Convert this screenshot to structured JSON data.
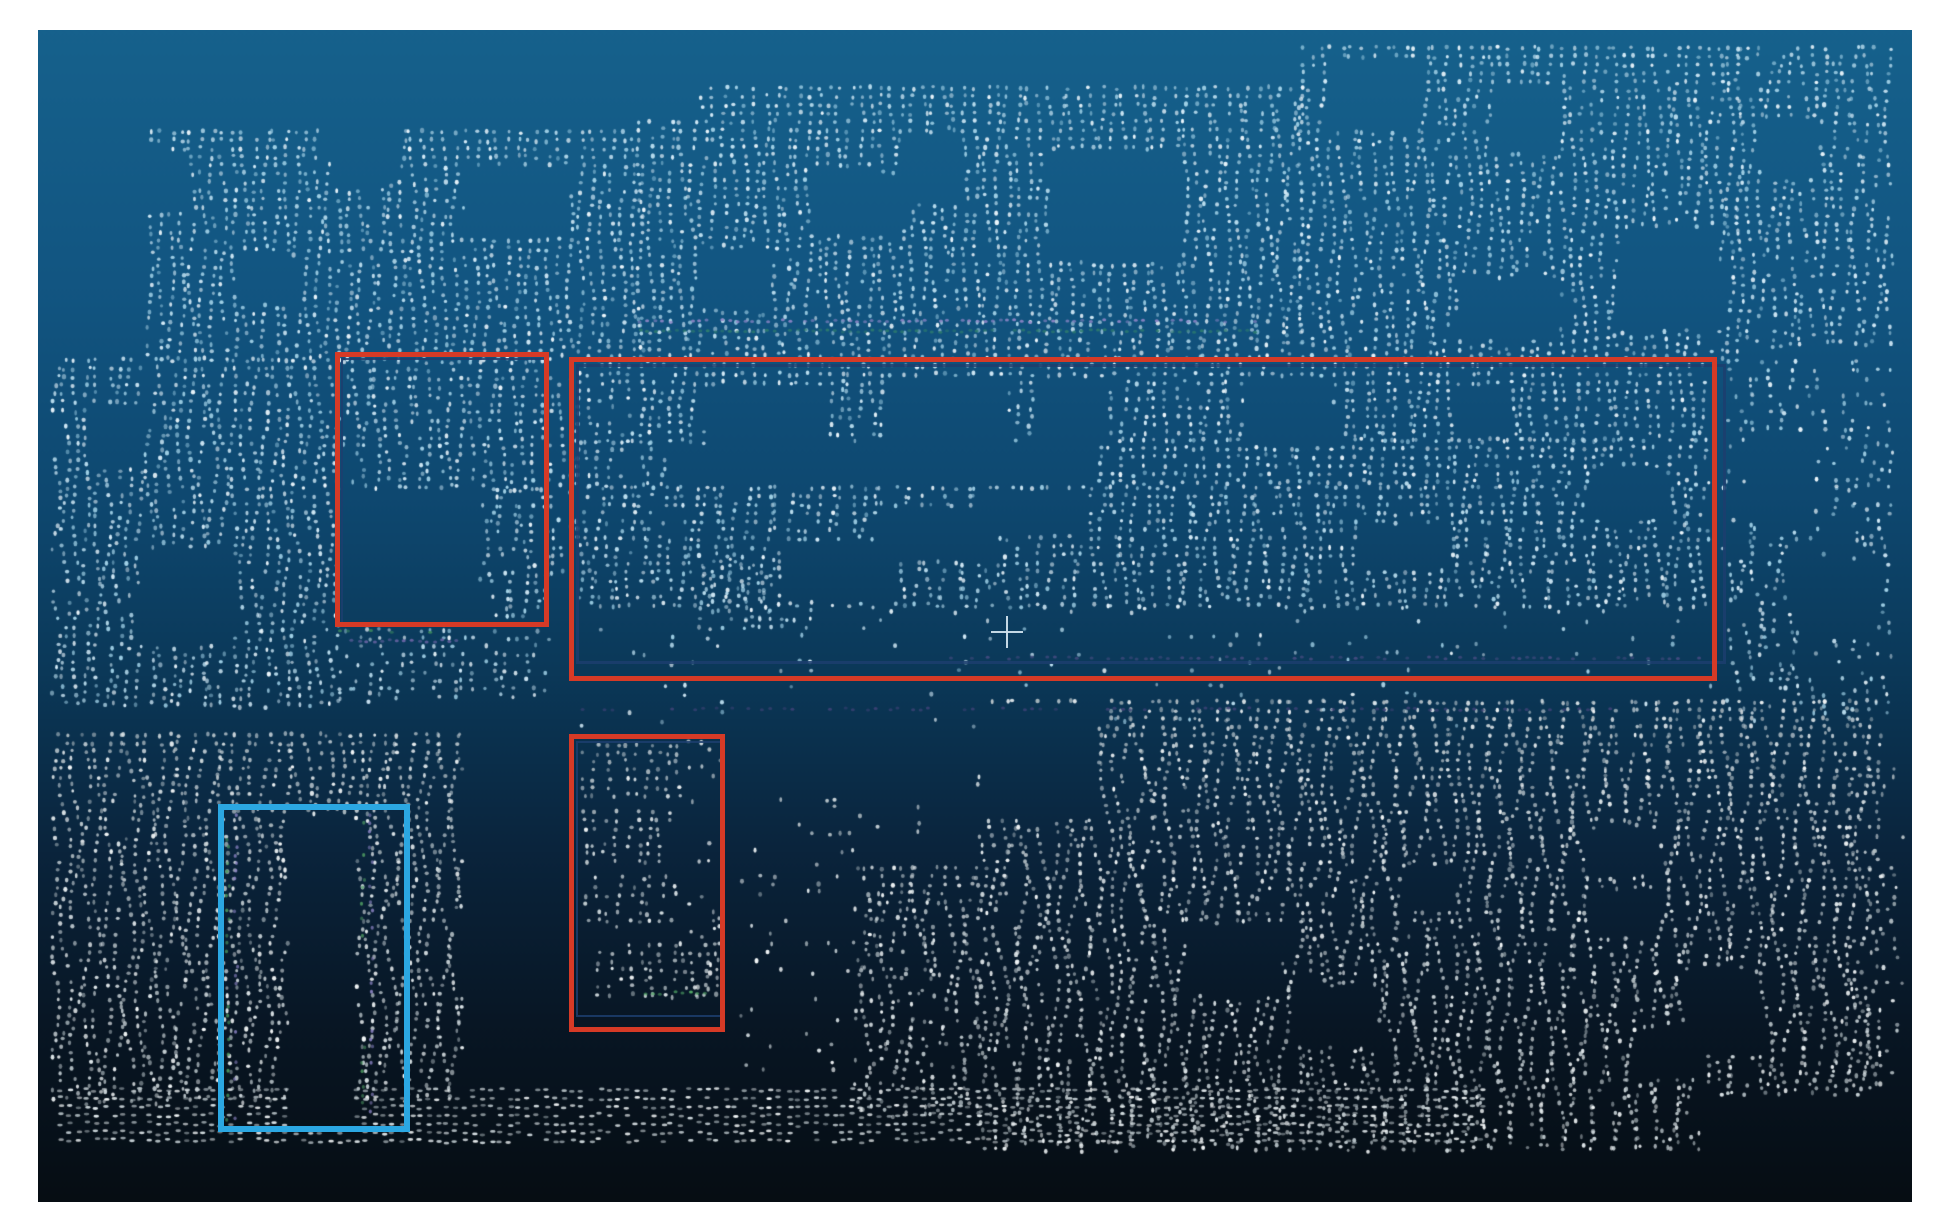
{
  "window": {
    "frame_color": "#ffffff",
    "viewport": {
      "x": 38,
      "y": 30,
      "w": 1874,
      "h": 1172
    },
    "background_gradient": [
      [
        0.0,
        "#16618c"
      ],
      [
        0.22,
        "#125581"
      ],
      [
        0.4,
        "#0e4870"
      ],
      [
        0.55,
        "#0b3858"
      ],
      [
        0.7,
        "#0a243c"
      ],
      [
        0.85,
        "#081624"
      ],
      [
        1.0,
        "#060d13"
      ]
    ]
  },
  "annotations": {
    "red_color": "#d63a26",
    "cyan_color": "#2ba7e2",
    "ghost_color": "#1c3e6e",
    "boxes": [
      {
        "id": "red-annotation-box-1",
        "color": "#d63a26",
        "x": 335,
        "y": 352,
        "w": 214,
        "h": 275,
        "stroke": 5
      },
      {
        "id": "red-annotation-box-2",
        "color": "#d63a26",
        "x": 569,
        "y": 357,
        "w": 1148,
        "h": 324,
        "stroke": 5
      },
      {
        "id": "red-annotation-box-3",
        "color": "#d63a26",
        "x": 569,
        "y": 734,
        "w": 156,
        "h": 298,
        "stroke": 5
      },
      {
        "id": "cyan-annotation-box-1",
        "color": "#2ba7e2",
        "x": 218,
        "y": 804,
        "w": 192,
        "h": 328,
        "stroke": 6
      }
    ],
    "ghost_boxes": [
      {
        "x": 576,
        "y": 364,
        "w": 1150,
        "h": 300,
        "stroke": 3
      },
      {
        "x": 341,
        "y": 358,
        "w": 207,
        "h": 266,
        "stroke": 2
      },
      {
        "x": 576,
        "y": 741,
        "w": 146,
        "h": 276,
        "stroke": 2
      }
    ],
    "crosshair": {
      "x": 1007,
      "y": 632,
      "arm": 16,
      "thickness": 2.5,
      "color": "#cfe0ec"
    }
  },
  "pointcloud": {
    "seed": 20240601,
    "grid": {
      "dx": 10.5,
      "dy": 8.4,
      "dot_w": 3.4,
      "dot_h": 4.2
    },
    "palette_blue": [
      "#eaf5fb",
      "#d2eaf7",
      "#b9ddee",
      "#a0d0e6"
    ],
    "palette_gray": [
      "#f1f5f6",
      "#dfe7ea",
      "#cad4d8",
      "#b6c1c6"
    ],
    "regions": [
      {
        "x": 150,
        "y": 132,
        "w": 490,
        "h": 228,
        "d": 0.92,
        "tint": "blue",
        "wave": 3.0
      },
      {
        "x": 640,
        "y": 88,
        "w": 660,
        "h": 272,
        "d": 0.9,
        "tint": "blue",
        "wave": 3.0
      },
      {
        "x": 1300,
        "y": 48,
        "w": 440,
        "h": 312,
        "d": 0.86,
        "tint": "blue",
        "wave": 3.5
      },
      {
        "x": 1740,
        "y": 48,
        "w": 150,
        "h": 300,
        "d": 0.78,
        "tint": "blue",
        "wave": 4.0
      },
      {
        "x": 55,
        "y": 360,
        "w": 282,
        "h": 348,
        "d": 0.9,
        "tint": "blue",
        "wave": 4.0
      },
      {
        "x": 337,
        "y": 630,
        "w": 210,
        "h": 72,
        "d": 0.55,
        "tint": "blue",
        "wave": 3.0
      },
      {
        "x": 345,
        "y": 362,
        "w": 196,
        "h": 128,
        "d": 0.85,
        "tint": "blue",
        "wave": 3.0
      },
      {
        "x": 482,
        "y": 490,
        "w": 66,
        "h": 132,
        "d": 0.7,
        "tint": "blue",
        "wave": 4.0
      },
      {
        "x": 551,
        "y": 378,
        "w": 18,
        "h": 195,
        "d": 0.6,
        "tint": "blue",
        "wave": 2.0
      },
      {
        "x": 578,
        "y": 366,
        "w": 1128,
        "h": 76,
        "d": 0.88,
        "tint": "blue",
        "wave": 3.0
      },
      {
        "x": 578,
        "y": 442,
        "w": 84,
        "h": 46,
        "d": 0.8,
        "tint": "blue",
        "wave": 3.0
      },
      {
        "x": 1100,
        "y": 440,
        "w": 606,
        "h": 48,
        "d": 0.85,
        "tint": "blue",
        "wave": 3.0
      },
      {
        "x": 578,
        "y": 488,
        "w": 1128,
        "h": 122,
        "d": 0.85,
        "tint": "blue",
        "wave": 4.0
      },
      {
        "x": 700,
        "y": 560,
        "w": 115,
        "h": 72,
        "d": 0.7,
        "tint": "blue",
        "wave": 4.0
      },
      {
        "x": 590,
        "y": 612,
        "w": 1110,
        "h": 60,
        "d": 0.1,
        "tint": "blue",
        "wave": 3.0
      },
      {
        "x": 1725,
        "y": 362,
        "w": 165,
        "h": 358,
        "d": 0.5,
        "tint": "blue",
        "wave": 5.0
      },
      {
        "x": 578,
        "y": 686,
        "w": 1130,
        "h": 42,
        "d": 0.07,
        "tint": "blue",
        "wave": 3.0
      },
      {
        "x": 55,
        "y": 735,
        "w": 405,
        "h": 368,
        "d": 0.92,
        "tint": "gray",
        "wave": 5.0
      },
      {
        "x": 585,
        "y": 745,
        "w": 95,
        "h": 55,
        "d": 0.8,
        "tint": "gray",
        "wave": 3.0
      },
      {
        "x": 585,
        "y": 812,
        "w": 82,
        "h": 50,
        "d": 0.75,
        "tint": "gray",
        "wave": 3.0
      },
      {
        "x": 588,
        "y": 878,
        "w": 85,
        "h": 50,
        "d": 0.7,
        "tint": "gray",
        "wave": 3.0
      },
      {
        "x": 600,
        "y": 945,
        "w": 118,
        "h": 52,
        "d": 0.8,
        "tint": "gray",
        "wave": 3.0
      },
      {
        "x": 690,
        "y": 742,
        "w": 28,
        "h": 255,
        "d": 0.25,
        "tint": "gray",
        "wave": 3.0
      },
      {
        "x": 742,
        "y": 800,
        "w": 195,
        "h": 295,
        "d": 0.13,
        "tint": "gray",
        "wave": 4.0
      },
      {
        "x": 855,
        "y": 868,
        "w": 125,
        "h": 250,
        "d": 0.75,
        "tint": "gray",
        "wave": 6.0
      },
      {
        "x": 980,
        "y": 702,
        "w": 898,
        "h": 450,
        "d": 0.9,
        "tint": "gray",
        "wave": 6.0
      },
      {
        "x": 1845,
        "y": 760,
        "w": 55,
        "h": 330,
        "d": 0.3,
        "tint": "gray",
        "wave": 5.0
      },
      {
        "x": 60,
        "y": 1090,
        "w": 1420,
        "h": 52,
        "d": 0.85,
        "tint": "gray",
        "wave": 1.0,
        "dash": true
      }
    ],
    "holes": [
      {
        "x": 120,
        "y": 150,
        "w": 65,
        "h": 60
      },
      {
        "x": 330,
        "y": 118,
        "w": 68,
        "h": 66
      },
      {
        "x": 465,
        "y": 165,
        "w": 105,
        "h": 70
      },
      {
        "x": 600,
        "y": 60,
        "w": 100,
        "h": 55
      },
      {
        "x": 810,
        "y": 172,
        "w": 82,
        "h": 62
      },
      {
        "x": 900,
        "y": 138,
        "w": 60,
        "h": 62
      },
      {
        "x": 1048,
        "y": 152,
        "w": 132,
        "h": 108
      },
      {
        "x": 1330,
        "y": 58,
        "w": 92,
        "h": 72
      },
      {
        "x": 1498,
        "y": 88,
        "w": 64,
        "h": 62
      },
      {
        "x": 1620,
        "y": 228,
        "w": 100,
        "h": 102
      },
      {
        "x": 1460,
        "y": 278,
        "w": 100,
        "h": 62
      },
      {
        "x": 700,
        "y": 250,
        "w": 70,
        "h": 60
      },
      {
        "x": 240,
        "y": 255,
        "w": 60,
        "h": 50
      },
      {
        "x": 1760,
        "y": 120,
        "w": 60,
        "h": 60
      },
      {
        "x": 140,
        "y": 548,
        "w": 95,
        "h": 98
      },
      {
        "x": 95,
        "y": 408,
        "w": 48,
        "h": 58
      },
      {
        "x": 340,
        "y": 492,
        "w": 140,
        "h": 132
      },
      {
        "x": 705,
        "y": 385,
        "w": 115,
        "h": 100
      },
      {
        "x": 888,
        "y": 380,
        "w": 120,
        "h": 62
      },
      {
        "x": 1040,
        "y": 378,
        "w": 70,
        "h": 64
      },
      {
        "x": 1243,
        "y": 378,
        "w": 90,
        "h": 66
      },
      {
        "x": 1455,
        "y": 386,
        "w": 56,
        "h": 50
      },
      {
        "x": 780,
        "y": 540,
        "w": 120,
        "h": 58
      },
      {
        "x": 880,
        "y": 508,
        "w": 120,
        "h": 52
      },
      {
        "x": 985,
        "y": 490,
        "w": 105,
        "h": 46
      },
      {
        "x": 1360,
        "y": 525,
        "w": 92,
        "h": 44
      },
      {
        "x": 1592,
        "y": 470,
        "w": 75,
        "h": 50
      },
      {
        "x": 1745,
        "y": 430,
        "w": 70,
        "h": 92
      },
      {
        "x": 1800,
        "y": 562,
        "w": 78,
        "h": 78
      },
      {
        "x": 288,
        "y": 815,
        "w": 68,
        "h": 318
      },
      {
        "x": 980,
        "y": 702,
        "w": 118,
        "h": 118
      },
      {
        "x": 1185,
        "y": 925,
        "w": 95,
        "h": 70
      },
      {
        "x": 1290,
        "y": 990,
        "w": 85,
        "h": 55
      },
      {
        "x": 1588,
        "y": 828,
        "w": 72,
        "h": 48
      },
      {
        "x": 1602,
        "y": 892,
        "w": 56,
        "h": 46
      },
      {
        "x": 1640,
        "y": 1028,
        "w": 62,
        "h": 50
      },
      {
        "x": 1688,
        "y": 972,
        "w": 72,
        "h": 82
      },
      {
        "x": 1410,
        "y": 868,
        "w": 46,
        "h": 44
      },
      {
        "x": 1700,
        "y": 1095,
        "w": 190,
        "h": 60
      }
    ],
    "accents": [
      {
        "type": "hrow",
        "x": 640,
        "y": 321,
        "len": 615,
        "color": "#8f86c8",
        "d": 0.75
      },
      {
        "type": "hrow",
        "x": 640,
        "y": 331,
        "len": 615,
        "color": "#2e7d6e",
        "d": 0.9
      },
      {
        "type": "hrow",
        "x": 950,
        "y": 658,
        "len": 750,
        "color": "#474c82",
        "d": 0.55
      },
      {
        "type": "hrow",
        "x": 575,
        "y": 709,
        "len": 1040,
        "color": "#3d4276",
        "d": 0.5
      },
      {
        "type": "hrow",
        "x": 337,
        "y": 641,
        "len": 125,
        "color": "#6f66a8",
        "d": 0.7
      },
      {
        "type": "hrow",
        "x": 340,
        "y": 631,
        "len": 95,
        "color": "#3f8f5f",
        "d": 0.45
      },
      {
        "type": "vcol",
        "x": 228,
        "y": 815,
        "len": 310,
        "color": "#4e9a62",
        "d": 0.5
      },
      {
        "type": "vcol",
        "x": 236,
        "y": 815,
        "len": 310,
        "color": "#8f86c8",
        "d": 0.5
      },
      {
        "type": "vcol",
        "x": 363,
        "y": 815,
        "len": 310,
        "color": "#4e9a62",
        "d": 0.5
      },
      {
        "type": "vcol",
        "x": 371,
        "y": 815,
        "len": 310,
        "color": "#8f86c8",
        "d": 0.5
      },
      {
        "type": "hrow",
        "x": 645,
        "y": 993,
        "len": 70,
        "color": "#57b06a",
        "d": 0.85
      }
    ]
  }
}
